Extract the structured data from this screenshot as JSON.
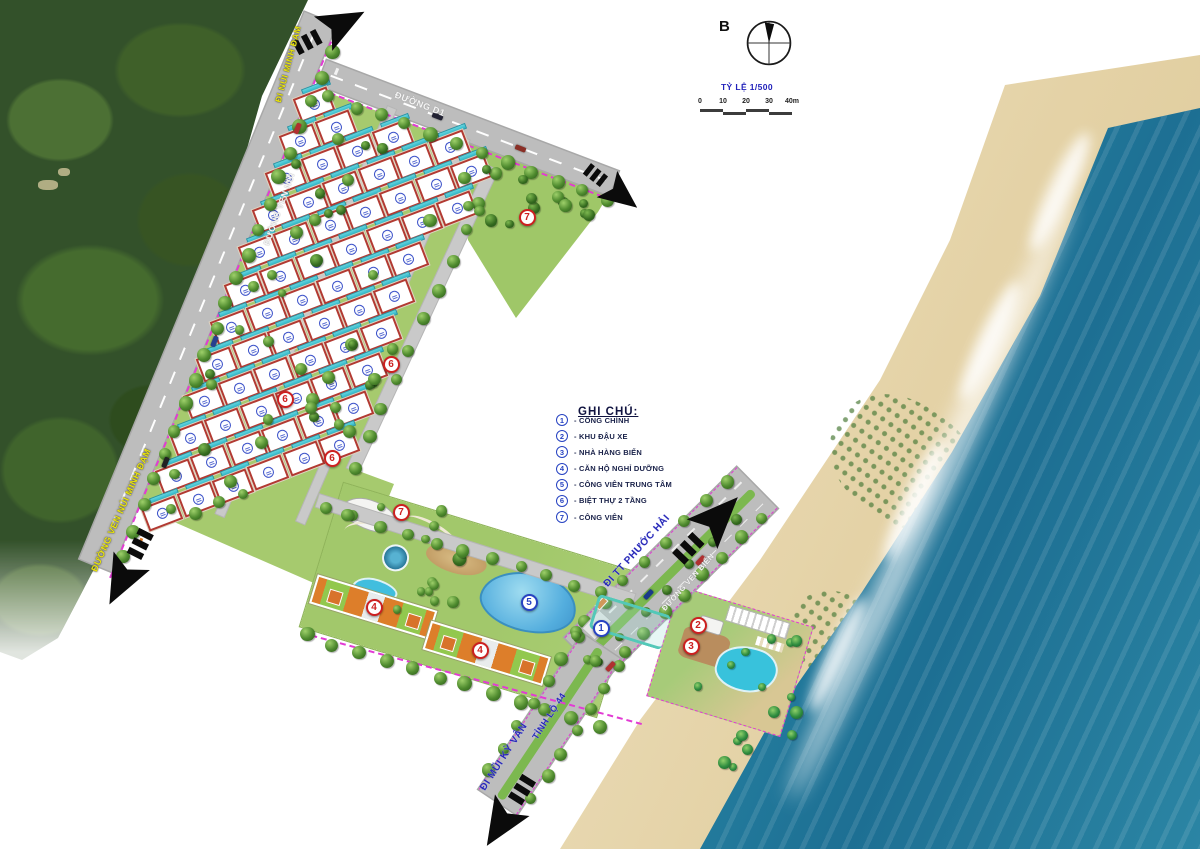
{
  "map": {
    "north_label": "B",
    "scale_label": "TỶ LỆ 1/500",
    "scalebar_ticks": [
      "0",
      "10",
      "20",
      "30",
      "40m"
    ]
  },
  "legend": {
    "title": "GHI CHÚ:",
    "items": [
      {
        "num": "1",
        "label": "- CỔNG CHÍNH"
      },
      {
        "num": "2",
        "label": "- KHU ĐẬU XE"
      },
      {
        "num": "3",
        "label": "- NHÀ HÀNG BIỂN"
      },
      {
        "num": "4",
        "label": "- CĂN HỘ NGHỈ DƯỠNG"
      },
      {
        "num": "5",
        "label": "- CÔNG VIÊN TRUNG TÂM"
      },
      {
        "num": "6",
        "label": "- BIỆT THỰ 2 TẦNG"
      },
      {
        "num": "7",
        "label": "- CÔNG VIÊN"
      }
    ]
  },
  "road_labels": [
    {
      "id": "di-nui-minh-dam",
      "text": "ĐI NÚI MINH ĐẠM",
      "x": 288,
      "y": 64,
      "rot": -75,
      "style": "yellow",
      "size": 8.5
    },
    {
      "id": "duong-ven-nui",
      "text": "ĐƯỜNG VEN NÚI",
      "x": 279,
      "y": 209,
      "rot": -70,
      "style": "white",
      "size": 8.5
    },
    {
      "id": "duong-ven-nui-minh-dam",
      "text": "ĐƯỜNG VEN NÚI MINH ĐẠM",
      "x": 121,
      "y": 510,
      "rot": -66,
      "style": "yellow",
      "size": 9
    },
    {
      "id": "duong-d1",
      "text": "ĐƯỜNG D1",
      "x": 420,
      "y": 104,
      "rot": 21,
      "style": "white",
      "size": 9
    },
    {
      "id": "di-tt-phuoc-hai",
      "text": "ĐI TT PHƯỚC HẢI",
      "x": 637,
      "y": 551,
      "rot": -48,
      "style": "blue",
      "size": 10
    },
    {
      "id": "duong-ven-bien",
      "text": "ĐƯỜNG VEN BIỂN",
      "x": 688,
      "y": 582,
      "rot": -48,
      "style": "white",
      "size": 7.5
    },
    {
      "id": "tinh-lo-44",
      "text": "TỈNH LỘ 44",
      "x": 549,
      "y": 716,
      "rot": -57,
      "style": "blue",
      "size": 9
    },
    {
      "id": "di-mui-ky-van",
      "text": "ĐI MŨI KỲ VÂN",
      "x": 504,
      "y": 757,
      "rot": -57,
      "style": "blue",
      "size": 10
    }
  ],
  "markers": [
    {
      "num": "1",
      "x": 601,
      "y": 628,
      "color": "blue"
    },
    {
      "num": "2",
      "x": 698,
      "y": 625,
      "color": "red"
    },
    {
      "num": "3",
      "x": 691,
      "y": 646,
      "color": "red"
    },
    {
      "num": "4",
      "x": 374,
      "y": 607,
      "color": "red"
    },
    {
      "num": "4",
      "x": 480,
      "y": 650,
      "color": "red"
    },
    {
      "num": "5",
      "x": 529,
      "y": 602,
      "color": "blue"
    },
    {
      "num": "6",
      "x": 391,
      "y": 364,
      "color": "red"
    },
    {
      "num": "6",
      "x": 285,
      "y": 399,
      "color": "red"
    },
    {
      "num": "6",
      "x": 332,
      "y": 458,
      "color": "red"
    },
    {
      "num": "7",
      "x": 527,
      "y": 217,
      "color": "red"
    },
    {
      "num": "7",
      "x": 401,
      "y": 512,
      "color": "red"
    }
  ],
  "colors": {
    "forest": "#33512a",
    "ocean_deep": "#1d6f93",
    "ocean_shallow": "#cdeceb",
    "sand": "#e4d2a6",
    "road": "#bdbdbd",
    "site_green": "#a6ca6e",
    "pool_teal": "#3fc0d0",
    "villa_border": "#b23a32",
    "marker_blue": "#2743c2",
    "marker_red": "#cc2020",
    "boundary_pink": "#e23bd4",
    "label_yellow": "#e9e40c",
    "label_blue": "#2a2ab8"
  }
}
